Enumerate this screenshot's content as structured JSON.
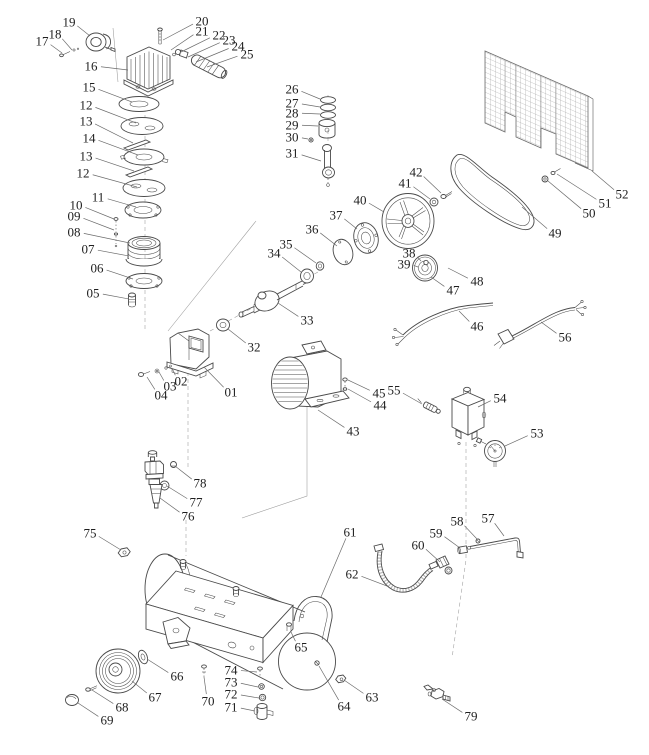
{
  "diagram": {
    "type": "exploded-parts-diagram",
    "subject": "air compressor",
    "colors": {
      "background": "#ffffff",
      "line": "#4a4a4a",
      "label": "#1f1f1f",
      "leader": "#6b6b6b"
    },
    "labels": [
      {
        "text": "01",
        "x": 231,
        "y": 392,
        "tx": 204,
        "ty": 367
      },
      {
        "text": "02",
        "x": 181,
        "y": 381,
        "tx": 172,
        "ty": 368
      },
      {
        "text": "03",
        "x": 170,
        "y": 386,
        "tx": 159,
        "ty": 372
      },
      {
        "text": "04",
        "x": 161,
        "y": 395,
        "tx": 147,
        "ty": 377
      },
      {
        "text": "05",
        "x": 93,
        "y": 293,
        "tx": 129,
        "ty": 299
      },
      {
        "text": "06",
        "x": 97,
        "y": 268,
        "tx": 133,
        "ty": 279
      },
      {
        "text": "07",
        "x": 88,
        "y": 249,
        "tx": 129,
        "ty": 256
      },
      {
        "text": "08",
        "x": 74,
        "y": 232,
        "tx": 130,
        "ty": 243
      },
      {
        "text": "09",
        "x": 74,
        "y": 216,
        "tx": 114,
        "ty": 230
      },
      {
        "text": "10",
        "x": 76,
        "y": 205,
        "tx": 114,
        "ty": 219
      },
      {
        "text": "11",
        "x": 98,
        "y": 197,
        "tx": 136,
        "ty": 207
      },
      {
        "text": "12",
        "x": 86,
        "y": 105,
        "tx": 136,
        "ty": 123
      },
      {
        "text": "13",
        "x": 86,
        "y": 121,
        "tx": 133,
        "ty": 143
      },
      {
        "text": "14",
        "x": 89,
        "y": 138,
        "tx": 138,
        "ty": 155
      },
      {
        "text": "13",
        "x": 86,
        "y": 156,
        "tx": 134,
        "ty": 171
      },
      {
        "text": "12",
        "x": 83,
        "y": 173,
        "tx": 137,
        "ty": 187
      },
      {
        "text": "15",
        "x": 89,
        "y": 87,
        "tx": 132,
        "ty": 102
      },
      {
        "text": "16",
        "x": 91,
        "y": 66,
        "tx": 128,
        "ty": 70
      },
      {
        "text": "17",
        "x": 42,
        "y": 41,
        "tx": 62,
        "ty": 53
      },
      {
        "text": "18",
        "x": 55,
        "y": 34,
        "tx": 72,
        "ty": 50
      },
      {
        "text": "19",
        "x": 69,
        "y": 22,
        "tx": 90,
        "ty": 36
      },
      {
        "text": "20",
        "x": 202,
        "y": 21,
        "tx": 163,
        "ty": 40
      },
      {
        "text": "21",
        "x": 202,
        "y": 31,
        "tx": 171,
        "ty": 50
      },
      {
        "text": "22",
        "x": 219,
        "y": 35,
        "tx": 181,
        "ty": 52
      },
      {
        "text": "23",
        "x": 229,
        "y": 40,
        "tx": 188,
        "ty": 57
      },
      {
        "text": "24",
        "x": 238,
        "y": 46,
        "tx": 196,
        "ty": 62
      },
      {
        "text": "25",
        "x": 247,
        "y": 54,
        "tx": 207,
        "ty": 67
      },
      {
        "text": "26",
        "x": 292,
        "y": 89,
        "tx": 320,
        "ty": 99
      },
      {
        "text": "27",
        "x": 292,
        "y": 103,
        "tx": 320,
        "ty": 107
      },
      {
        "text": "28",
        "x": 292,
        "y": 113,
        "tx": 320,
        "ty": 114
      },
      {
        "text": "29",
        "x": 292,
        "y": 125,
        "tx": 318,
        "ty": 126
      },
      {
        "text": "30",
        "x": 292,
        "y": 137,
        "tx": 308,
        "ty": 139
      },
      {
        "text": "31",
        "x": 292,
        "y": 153,
        "tx": 321,
        "ty": 161
      },
      {
        "text": "32",
        "x": 254,
        "y": 347,
        "tx": 228,
        "ty": 329
      },
      {
        "text": "33",
        "x": 307,
        "y": 320,
        "tx": 278,
        "ty": 303
      },
      {
        "text": "34",
        "x": 274,
        "y": 253,
        "tx": 301,
        "ty": 272
      },
      {
        "text": "35",
        "x": 286,
        "y": 244,
        "tx": 316,
        "ty": 263
      },
      {
        "text": "36",
        "x": 312,
        "y": 229,
        "tx": 337,
        "ty": 246
      },
      {
        "text": "37",
        "x": 336,
        "y": 215,
        "tx": 357,
        "ty": 229
      },
      {
        "text": "38",
        "x": 409,
        "y": 253,
        "tx": 421,
        "ty": 261
      },
      {
        "text": "39",
        "x": 404,
        "y": 264,
        "tx": 418,
        "ty": 267
      },
      {
        "text": "40",
        "x": 360,
        "y": 200,
        "tx": 384,
        "ty": 212
      },
      {
        "text": "41",
        "x": 405,
        "y": 183,
        "tx": 430,
        "ty": 199
      },
      {
        "text": "42",
        "x": 416,
        "y": 172,
        "tx": 441,
        "ty": 193
      },
      {
        "text": "43",
        "x": 353,
        "y": 431,
        "tx": 318,
        "ty": 410
      },
      {
        "text": "44",
        "x": 380,
        "y": 405,
        "tx": 348,
        "ty": 389
      },
      {
        "text": "45",
        "x": 379,
        "y": 393,
        "tx": 348,
        "ty": 380
      },
      {
        "text": "46",
        "x": 477,
        "y": 326,
        "tx": 459,
        "ty": 311
      },
      {
        "text": "47",
        "x": 453,
        "y": 290,
        "tx": 431,
        "ty": 277
      },
      {
        "text": "48",
        "x": 477,
        "y": 281,
        "tx": 448,
        "ty": 268
      },
      {
        "text": "49",
        "x": 555,
        "y": 233,
        "tx": 522,
        "ty": 207
      },
      {
        "text": "50",
        "x": 589,
        "y": 213,
        "tx": 548,
        "ty": 181
      },
      {
        "text": "51",
        "x": 605,
        "y": 203,
        "tx": 557,
        "ty": 174
      },
      {
        "text": "52",
        "x": 622,
        "y": 194,
        "tx": 592,
        "ty": 171
      },
      {
        "text": "53",
        "x": 537,
        "y": 433,
        "tx": 505,
        "ty": 446
      },
      {
        "text": "54",
        "x": 500,
        "y": 398,
        "tx": 478,
        "ty": 407
      },
      {
        "text": "55",
        "x": 394,
        "y": 390,
        "tx": 422,
        "ty": 404
      },
      {
        "text": "56",
        "x": 565,
        "y": 337,
        "tx": 541,
        "ty": 322
      },
      {
        "text": "57",
        "x": 488,
        "y": 518,
        "tx": 504,
        "ty": 536
      },
      {
        "text": "58",
        "x": 457,
        "y": 521,
        "tx": 477,
        "ty": 539
      },
      {
        "text": "59",
        "x": 436,
        "y": 533,
        "tx": 460,
        "ty": 548
      },
      {
        "text": "60",
        "x": 418,
        "y": 545,
        "tx": 440,
        "ty": 562
      },
      {
        "text": "61",
        "x": 350,
        "y": 532,
        "tx": 321,
        "ty": 597
      },
      {
        "text": "62",
        "x": 352,
        "y": 574,
        "tx": 387,
        "ty": 586
      },
      {
        "text": "63",
        "x": 372,
        "y": 697,
        "tx": 344,
        "ty": 680
      },
      {
        "text": "64",
        "x": 344,
        "y": 706,
        "tx": 319,
        "ty": 666
      },
      {
        "text": "65",
        "x": 301,
        "y": 647,
        "tx": 291,
        "ty": 632
      },
      {
        "text": "66",
        "x": 177,
        "y": 676,
        "tx": 147,
        "ty": 659
      },
      {
        "text": "67",
        "x": 155,
        "y": 697,
        "tx": 132,
        "ty": 681
      },
      {
        "text": "68",
        "x": 122,
        "y": 707,
        "tx": 92,
        "ty": 690
      },
      {
        "text": "69",
        "x": 107,
        "y": 720,
        "tx": 78,
        "ty": 703
      },
      {
        "text": "70",
        "x": 208,
        "y": 701,
        "tx": 204,
        "ty": 677
      },
      {
        "text": "71",
        "x": 231,
        "y": 707,
        "tx": 255,
        "ty": 711
      },
      {
        "text": "72",
        "x": 231,
        "y": 694,
        "tx": 259,
        "ty": 698
      },
      {
        "text": "73",
        "x": 231,
        "y": 682,
        "tx": 258,
        "ty": 687
      },
      {
        "text": "74",
        "x": 231,
        "y": 670,
        "tx": 257,
        "ty": 672
      },
      {
        "text": "75",
        "x": 90,
        "y": 533,
        "tx": 121,
        "ty": 550
      },
      {
        "text": "76",
        "x": 188,
        "y": 516,
        "tx": 160,
        "ty": 498
      },
      {
        "text": "77",
        "x": 196,
        "y": 502,
        "tx": 167,
        "ty": 486
      },
      {
        "text": "78",
        "x": 200,
        "y": 483,
        "tx": 175,
        "ty": 466
      },
      {
        "text": "79",
        "x": 471,
        "y": 716,
        "tx": 442,
        "ty": 699
      }
    ]
  }
}
